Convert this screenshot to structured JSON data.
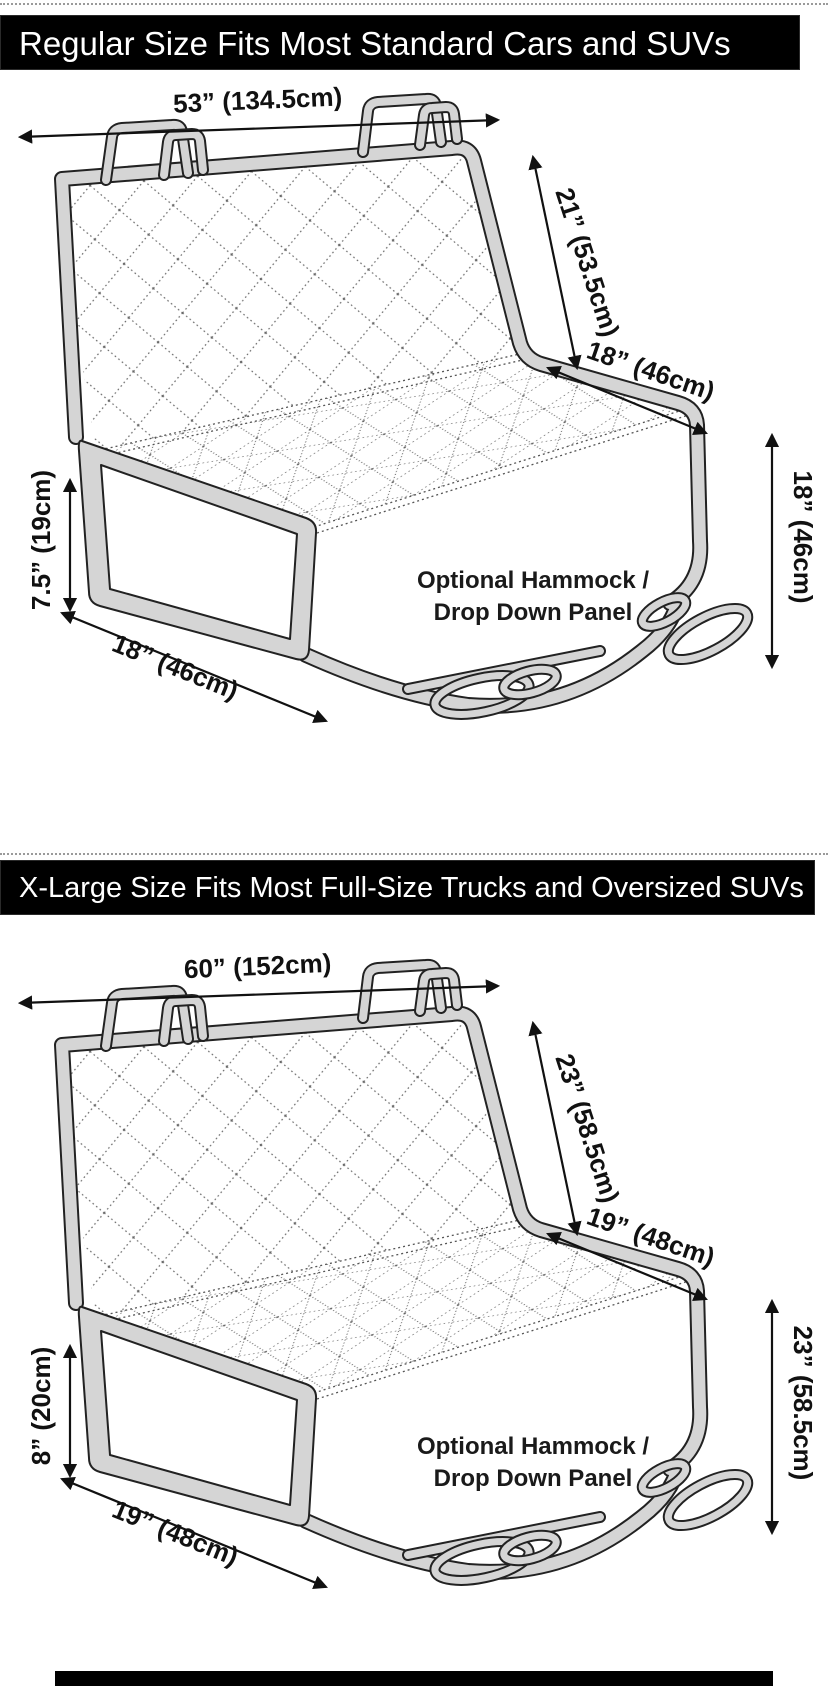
{
  "banners": {
    "regular": "Regular Size Fits Most Standard Cars and SUVs",
    "xlarge": "X-Large Size Fits Most Full-Size Trucks and Oversized SUVs"
  },
  "colors": {
    "banner_bg": "#000000",
    "banner_text": "#ffffff",
    "tube_fill": "#d5d5d5",
    "outline": "#222222",
    "label_text": "#111111"
  },
  "diagrams": [
    {
      "size": "regular",
      "labels": {
        "top_width": "53” (134.5cm)",
        "back_height": "21” (53.5cm)",
        "seat_depth": "18” (46cm)",
        "drop_height": "18” (46cm)",
        "flap_height": "7.5” (19cm)",
        "flap_width": "18” (46cm)",
        "hammock_line1": "Optional Hammock /",
        "hammock_line2": "Drop Down Panel"
      }
    },
    {
      "size": "x-large",
      "labels": {
        "top_width": "60” (152cm)",
        "back_height": "23” (58.5cm)",
        "seat_depth": "19” (48cm)",
        "drop_height": "23” (58.5cm)",
        "flap_height": "8” (20cm)",
        "flap_width": "19” (48cm)",
        "hammock_line1": "Optional Hammock /",
        "hammock_line2": "Drop Down Panel"
      }
    }
  ]
}
